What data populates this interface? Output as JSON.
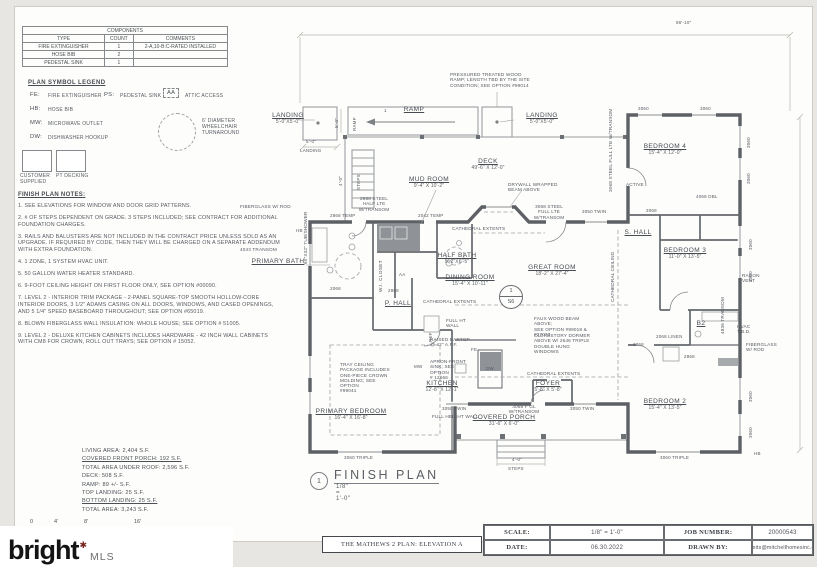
{
  "components_table": {
    "title": "COMPONENTS",
    "headers": [
      "TYPE",
      "COUNT",
      "COMMENTS"
    ],
    "rows": [
      [
        "FIRE EXTINGUISHER",
        "1",
        "2-A,10-B:C-RATED INSTALLED"
      ],
      [
        "HOSE BIB",
        "2",
        ""
      ],
      [
        "PEDESTAL SINK",
        "1",
        ""
      ]
    ]
  },
  "legend": {
    "title": "PLAN SYMBOL LEGEND",
    "items": [
      {
        "abbr": "FE:",
        "label": "FIRE EXTINGUISHER"
      },
      {
        "abbr": "PS:",
        "label": "PEDESTAL SINK"
      },
      {
        "abbr": "AA",
        "label": "ATTIC ACCESS"
      },
      {
        "abbr": "HB:",
        "label": "HOSE BIB"
      },
      {
        "abbr": "MW:",
        "label": "MICROWAVE OUTLET"
      },
      {
        "abbr": "DW:",
        "label": "DISHWASHER HOOKUP"
      }
    ],
    "swatches": [
      {
        "label": "CUSTOMER\nSUPPLIED"
      },
      {
        "label": "PT DECKING"
      }
    ],
    "wheelchair_note": "6' DIAMETER\nWHEELCHAIR\nTURNAROUND"
  },
  "notes": {
    "title": "FINISH PLAN NOTES:",
    "items": [
      "1. SEE ELEVATIONS FOR WINDOW AND DOOR GRID PATTERNS.",
      "2. # OF STEPS DEPENDENT ON GRADE. 3 STEPS INCLUDED; SEE CONTRACT FOR ADDITIONAL FOUNDATION CHARGES.",
      "3. RAILS AND BALUSTERS ARE NOT INCLUDED IN THE CONTRACT PRICE UNLESS SOLD AS AN UPGRADE. IF REQUIRED BY CODE, THEN THEY WILL BE CHARGED ON A SEPARATE ADDENDUM WITH EXTRA FOUNDATION.",
      "4. 1 ZONE, 1 SYSTEM HVAC UNIT.",
      "5. 50 GALLON WATER HEATER STANDARD.",
      "6. 9-FOOT CEILING HEIGHT ON FIRST FLOOR ONLY, SEE OPTION #00090.",
      "7. LEVEL 2 - INTERIOR TRIM PACKAGE - 2-PANEL SQUARE-TOP SMOOTH HOLLOW-CORE INTERIOR DOORS, 3 1/2\" ADAMS CASING ON ALL DOORS, WINDOWS, AND CASED OPENINGS, AND 5 1/4\" SPEED BASEBOARD THROUGHOUT; SEE OPTION #65019.",
      "8. BLOWN FIBERGLASS WALL INSULATION: WHOLE HOUSE; SEE OPTION # 51005.",
      "9. LEVEL 2 - DELUXE KITCHEN CABINETS INCLUDES HARDWARE - 42 INCH WALL CABINETS WITH CM8 FOR CROWN, ROLL OUT TRAYS; SEE OPTION # 15052."
    ]
  },
  "areas": {
    "lines": [
      "LIVING AREA: 2,404 S.F.",
      "COVERED FRONT PORCH: 192 S.F.",
      "TOTAL AREA UNDER ROOF: 2,596 S.F.",
      "DECK: 508 S.F.",
      "RAMP: 89 +/- S.F.",
      "TOP LANDING: 25 S.F.",
      "BOTTOM LANDING: 25 S.F.",
      "TOTAL AREA: 3,243 S.F."
    ],
    "scale_ticks": [
      "0",
      "4'",
      "8'",
      "16'"
    ]
  },
  "plan": {
    "rooms": [
      {
        "name": "LANDING",
        "dims": "5'-0\"X5'-0\""
      },
      {
        "name": "RAMP",
        "dims": ""
      },
      {
        "name": "LANDING",
        "dims": "5'-0\"X5'-0\""
      },
      {
        "name": "DECK",
        "dims": "49'-6\" X 12'-0\""
      },
      {
        "name": "MUD ROOM",
        "dims": "9'-4\" X 10'-2\""
      },
      {
        "name": "HALF BATH",
        "dims": "5'-2\"X6'-5\""
      },
      {
        "name": "DINING ROOM",
        "dims": "15'-4\" X 10'-11\""
      },
      {
        "name": "GREAT ROOM",
        "dims": "18'-2\" X 27'-4\""
      },
      {
        "name": "KITCHEN",
        "dims": "12'-8\" X 12'-1\""
      },
      {
        "name": "FOYER",
        "dims": "5'-8\" X 5'-8\""
      },
      {
        "name": "COVERED PORCH",
        "dims": "31'-6\" X 6'-0\""
      },
      {
        "name": "PRIMARY BEDROOM",
        "dims": "16'-4\" X 16'-8\""
      },
      {
        "name": "PRIMARY BATH",
        "dims": ""
      },
      {
        "name": "P. HALL",
        "dims": ""
      },
      {
        "name": "S. HALL",
        "dims": ""
      },
      {
        "name": "BEDROOM 4",
        "dims": "15'-4\" X 12'-0\""
      },
      {
        "name": "BEDROOM 3",
        "dims": "11'-0\" X 13'-5\""
      },
      {
        "name": "BEDROOM 2",
        "dims": "15'-4\" X 13'-5\""
      },
      {
        "name": "W.I. CLOSET",
        "dims": ""
      },
      {
        "name": "B2",
        "dims": ""
      }
    ],
    "annotations": [
      "PRESSURED TREATED WOOD\nRAMP; LENGTH TBD BY THE SITE\nCONDITION; SEE OPTION #99014",
      "DRYWALL WRAPPED\nBEAM ABOVE",
      "CATHEDRAL EXTENTS",
      "CATHEDRAL EXTENTS",
      "CATHEDRAL EXTENTS",
      "FAUX WOOD BEAM ABOVE;\nSEE OPTION #99018 & #27073",
      "CLERESTORY DORMER\nABOVE W/ 2646 TRIPLE\nDOUBLE HUNG WINDOWS",
      "TRAY CEILING\nPACKAGE INCLUDES\nONE-PIECE CROWN\nMOLDING; SEE OPTION\n#99041",
      "FULL HT\nWALL",
      "RAISED BARTOP\n@ 42\" A.F.F.",
      "APRON-FRONT\nSINK; SEE OPTION\n# 12666",
      "FULL HEIGHT WALL",
      "2868 STEEL\nHALF LTE\nW/TRANSOM",
      "3068 STEEL\nFULL LTE\nW/TRANSOM",
      "3068 STEEL FULL LTE W/TRANSOM",
      "FIBERGLASS W/ ROD",
      "FIBERGLASS\nW/ ROD",
      "HVAC\nT.B.D.",
      "RADON\nVENT",
      "CATHEDRAL CEILING",
      "ACTIVE",
      "4043 TRANSOM",
      "60\"X32\" TUB/SHOWER",
      "4836 TRANSOM",
      "3068 F GL\nW/TRANSOM"
    ],
    "tags": [
      "86'-10\"",
      "2868 TEMP",
      "2042 TEMP",
      "3050 TWIN",
      "3050 TWIN",
      "3050 TWIN",
      "3060 TRIPLE",
      "3060 TRIPLE",
      "3060",
      "3060",
      "3060",
      "3060",
      "3060",
      "3060",
      "3060",
      "3060",
      "4068 DBL",
      "2068 LINEN",
      "2868",
      "3068",
      "3068",
      "2868",
      "2068",
      "MW",
      "DW",
      "REF",
      "FE",
      "HB",
      "HB",
      "AA",
      "1",
      "5'-0\"",
      "LANDING",
      "5'-0\"",
      "RAMP",
      "4'-0\"",
      "STEPS",
      "4'-0\"",
      "STEPS"
    ],
    "section_marker": {
      "top": "1",
      "bottom": "S6"
    },
    "title": {
      "num": "1",
      "label": "FINISH PLAN",
      "scale": "1/8\" = 1'-0\""
    }
  },
  "title_block": {
    "plan_name": "THE MATHEWS 2 PLAN: ELEVATION A",
    "scale_label": "SCALE:",
    "scale_value": "1/8\" = 1'-0\"",
    "date_label": "DATE:",
    "date_value": "06.30.2022",
    "job_label": "JOB NUMBER:",
    "job_value": "20000543",
    "drawn_label": "DRAWN BY:",
    "drawn_value": "permits@mitchellhomesinc.com"
  },
  "logo": {
    "brand": "bright",
    "mark": "✱",
    "mls": "MLS"
  }
}
